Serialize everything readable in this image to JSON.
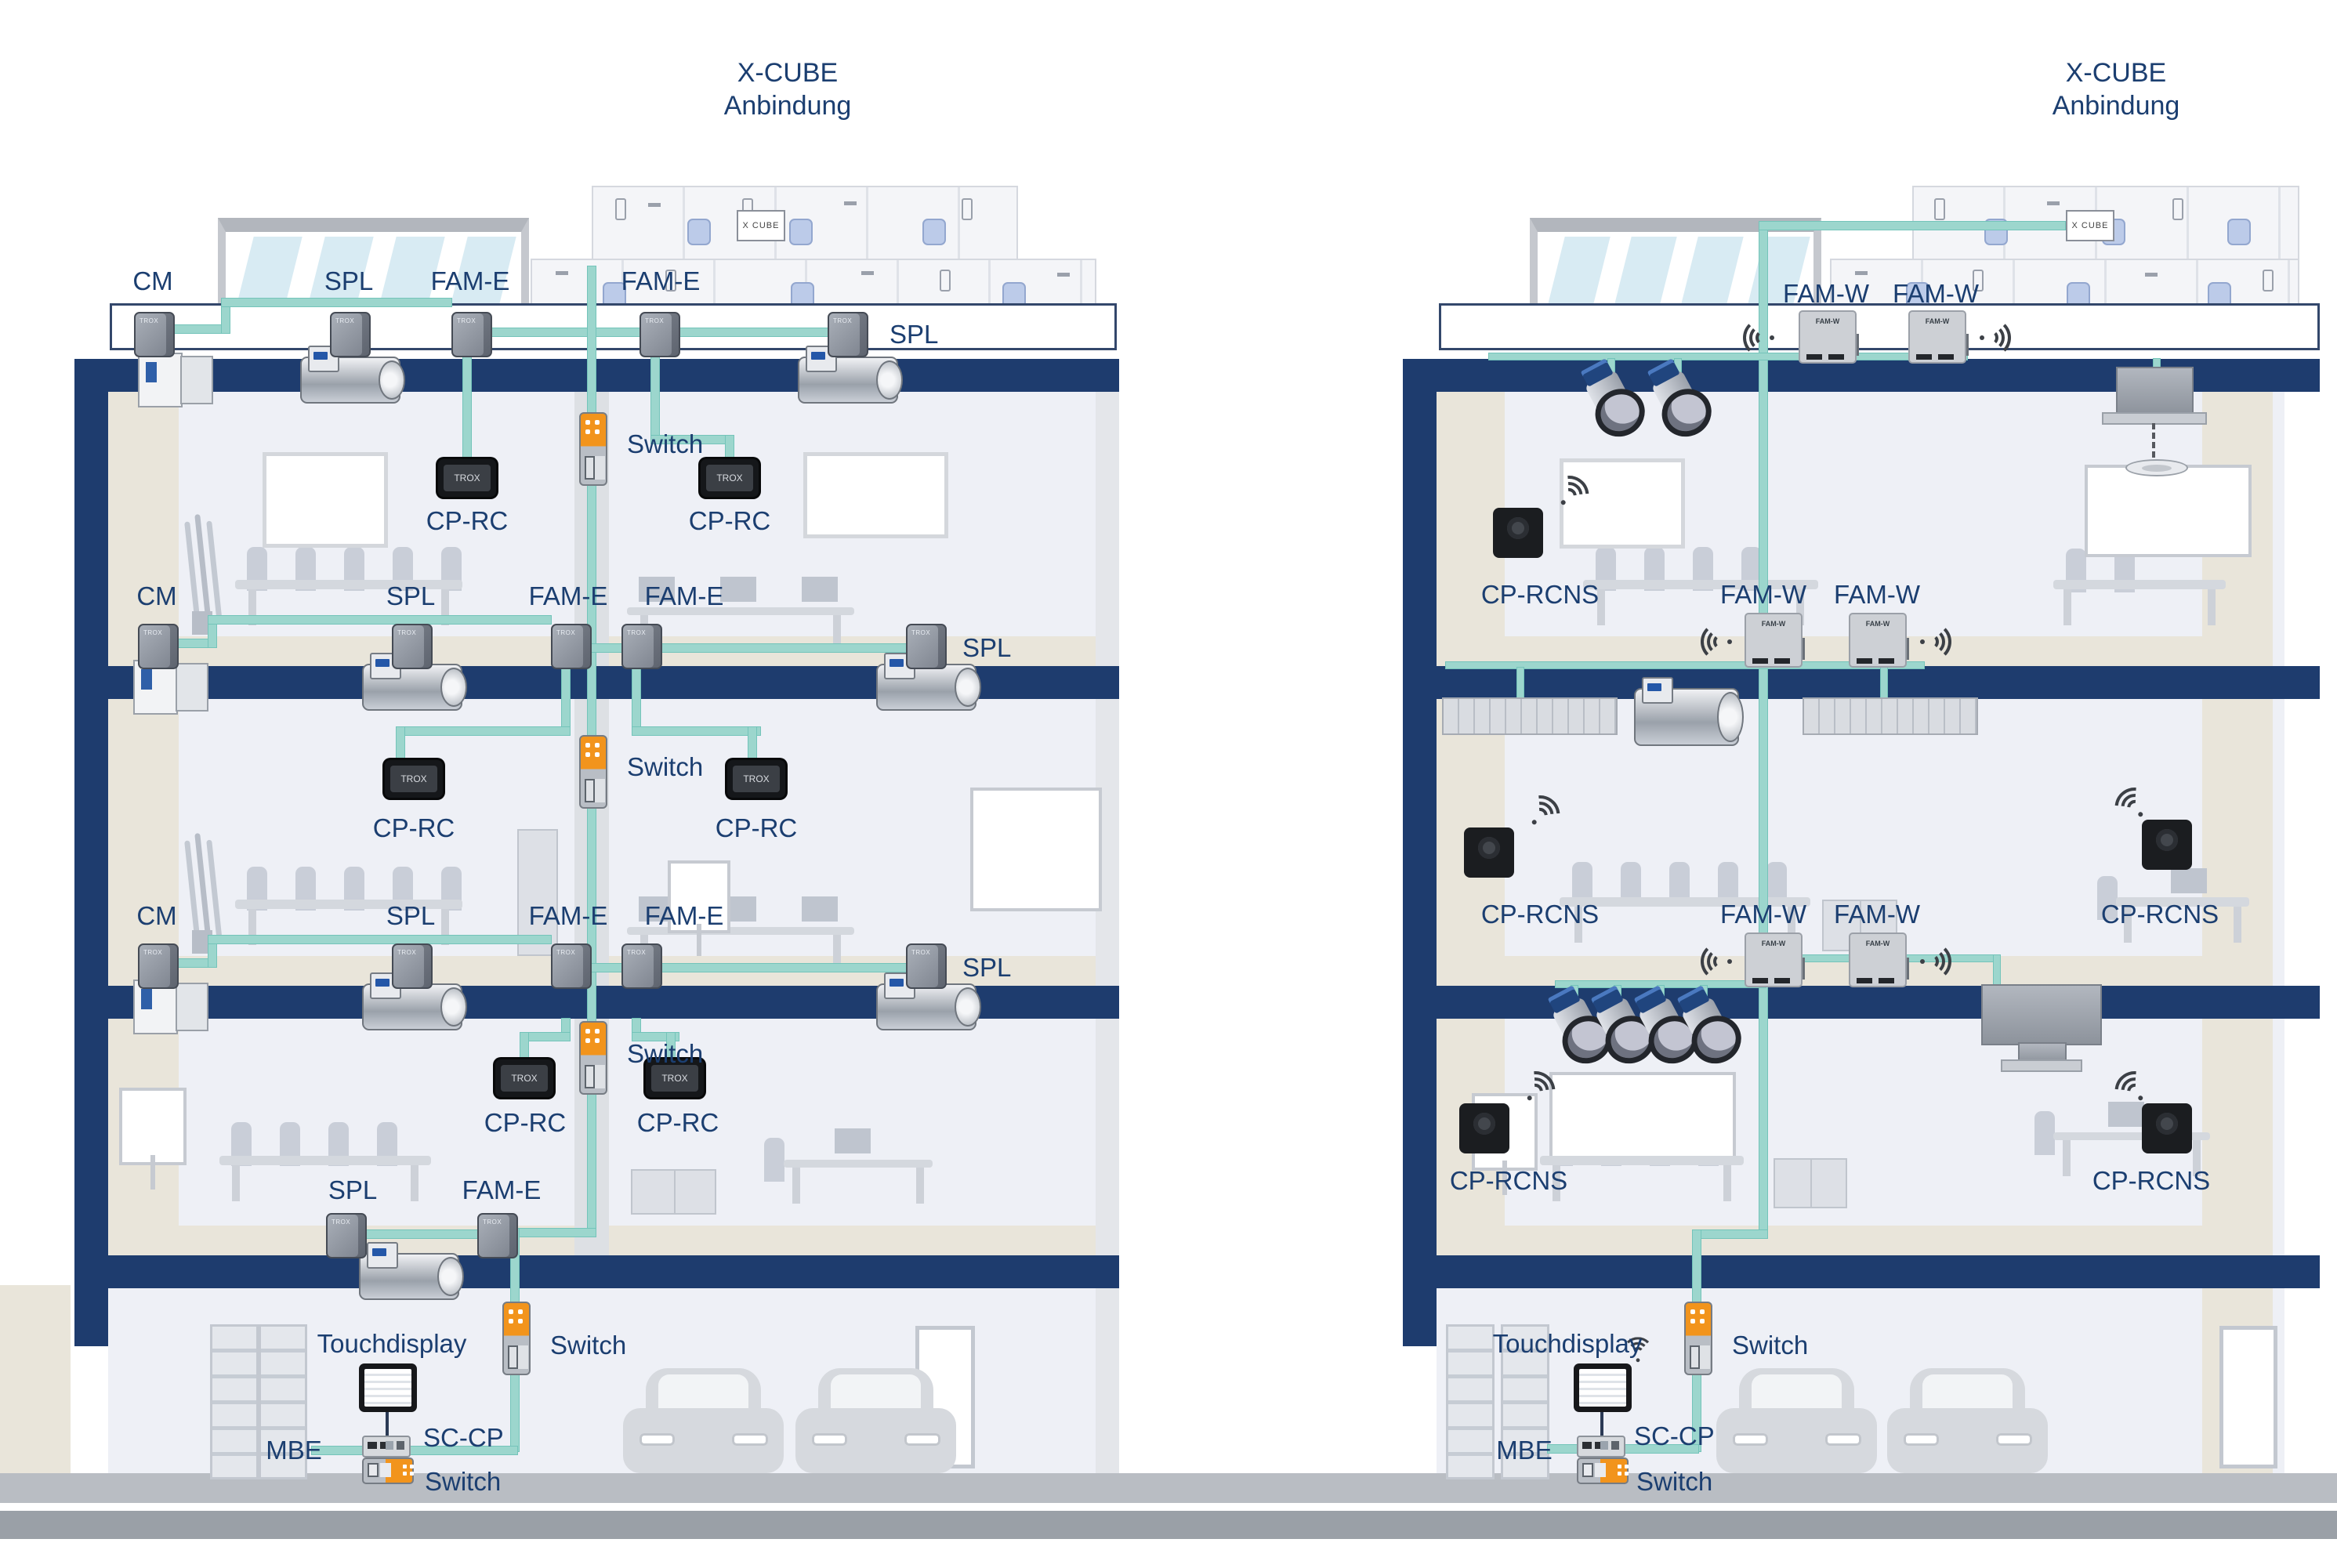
{
  "title": {
    "line1": "X-CUBE",
    "line2": "Anbindung"
  },
  "labels": {
    "cm": "CM",
    "spl": "SPL",
    "fam_e": "FAM-E",
    "fam_w": "FAM-W",
    "cp_rc": "CP-RC",
    "cp_rcns": "CP-RCNS",
    "switch": "Switch",
    "touchdisplay": "Touchdisplay",
    "mbe": "MBE",
    "sc_cp": "SC-CP"
  },
  "device_text": {
    "x_cube_badge": "X CUBE",
    "trox_logo": "TROX",
    "fam_w_face": "FAM-W"
  },
  "colors": {
    "label_text": "#1b3e70",
    "slab_navy": "#1e3c6e",
    "cable_teal": "#9cd6cd",
    "switch_orange": "#f2941c",
    "floor_beige": "#e9e5da",
    "room_background": "#eef0f6",
    "furniture_gray": "#c9ced8",
    "street_gray": "#9aa0a7"
  }
}
